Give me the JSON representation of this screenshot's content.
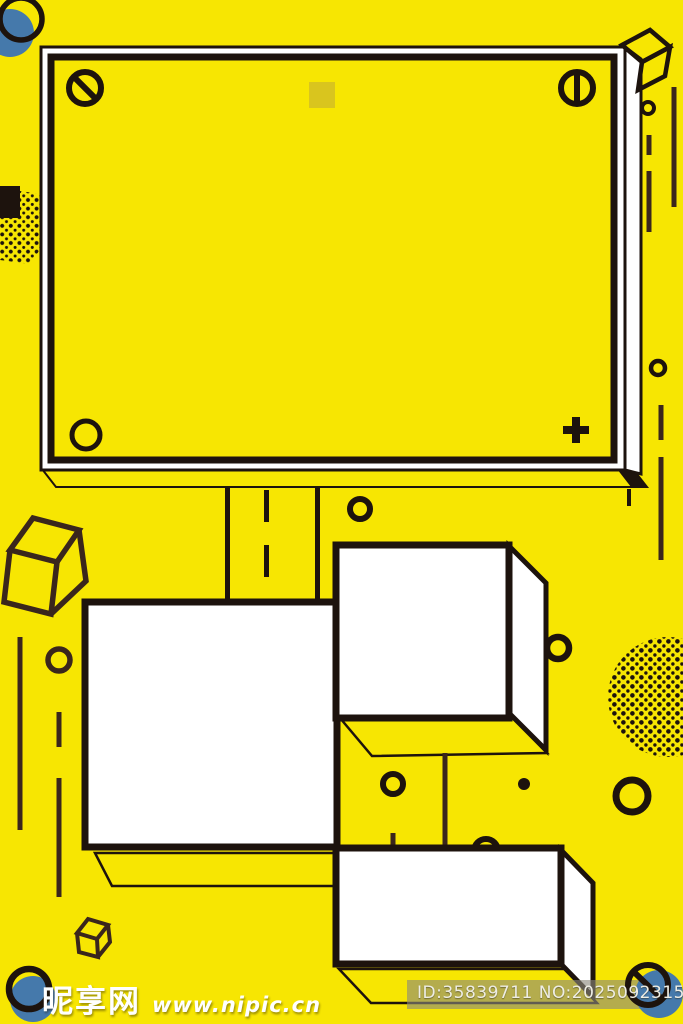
{
  "canvas": {
    "width": 683,
    "height": 1024
  },
  "palette": {
    "bg": "#f7e602",
    "ink": "#1d130d",
    "line": "#3a261c",
    "blue": "#4579ab",
    "panel": "#ffffff",
    "sq": "#d9c51e",
    "wm": "#ffffff",
    "idtx": "#eeede4"
  },
  "scene": {
    "style": "memphis-pop yellow poster background",
    "billboard": {
      "fill": "blank yellow panel",
      "corner_marks": [
        "slashed-screw-icon",
        "slotted-screw-icon",
        "circle-mark",
        "plus-mark"
      ],
      "inner_square_color": "#d9c51e"
    },
    "decor_icons": [
      "cube-wireframe-icon",
      "halftone-dots-blob",
      "blue-dot-circle",
      "striped-shadow-band",
      "dashed-road-line",
      "outline-circle",
      "no-symbol-icon"
    ],
    "white_boxes": 3
  },
  "watermark": {
    "site_name": "昵享网",
    "site_url": "www.nipic.cn",
    "image_id": "ID:35839711 NO:20250923154347266106"
  }
}
